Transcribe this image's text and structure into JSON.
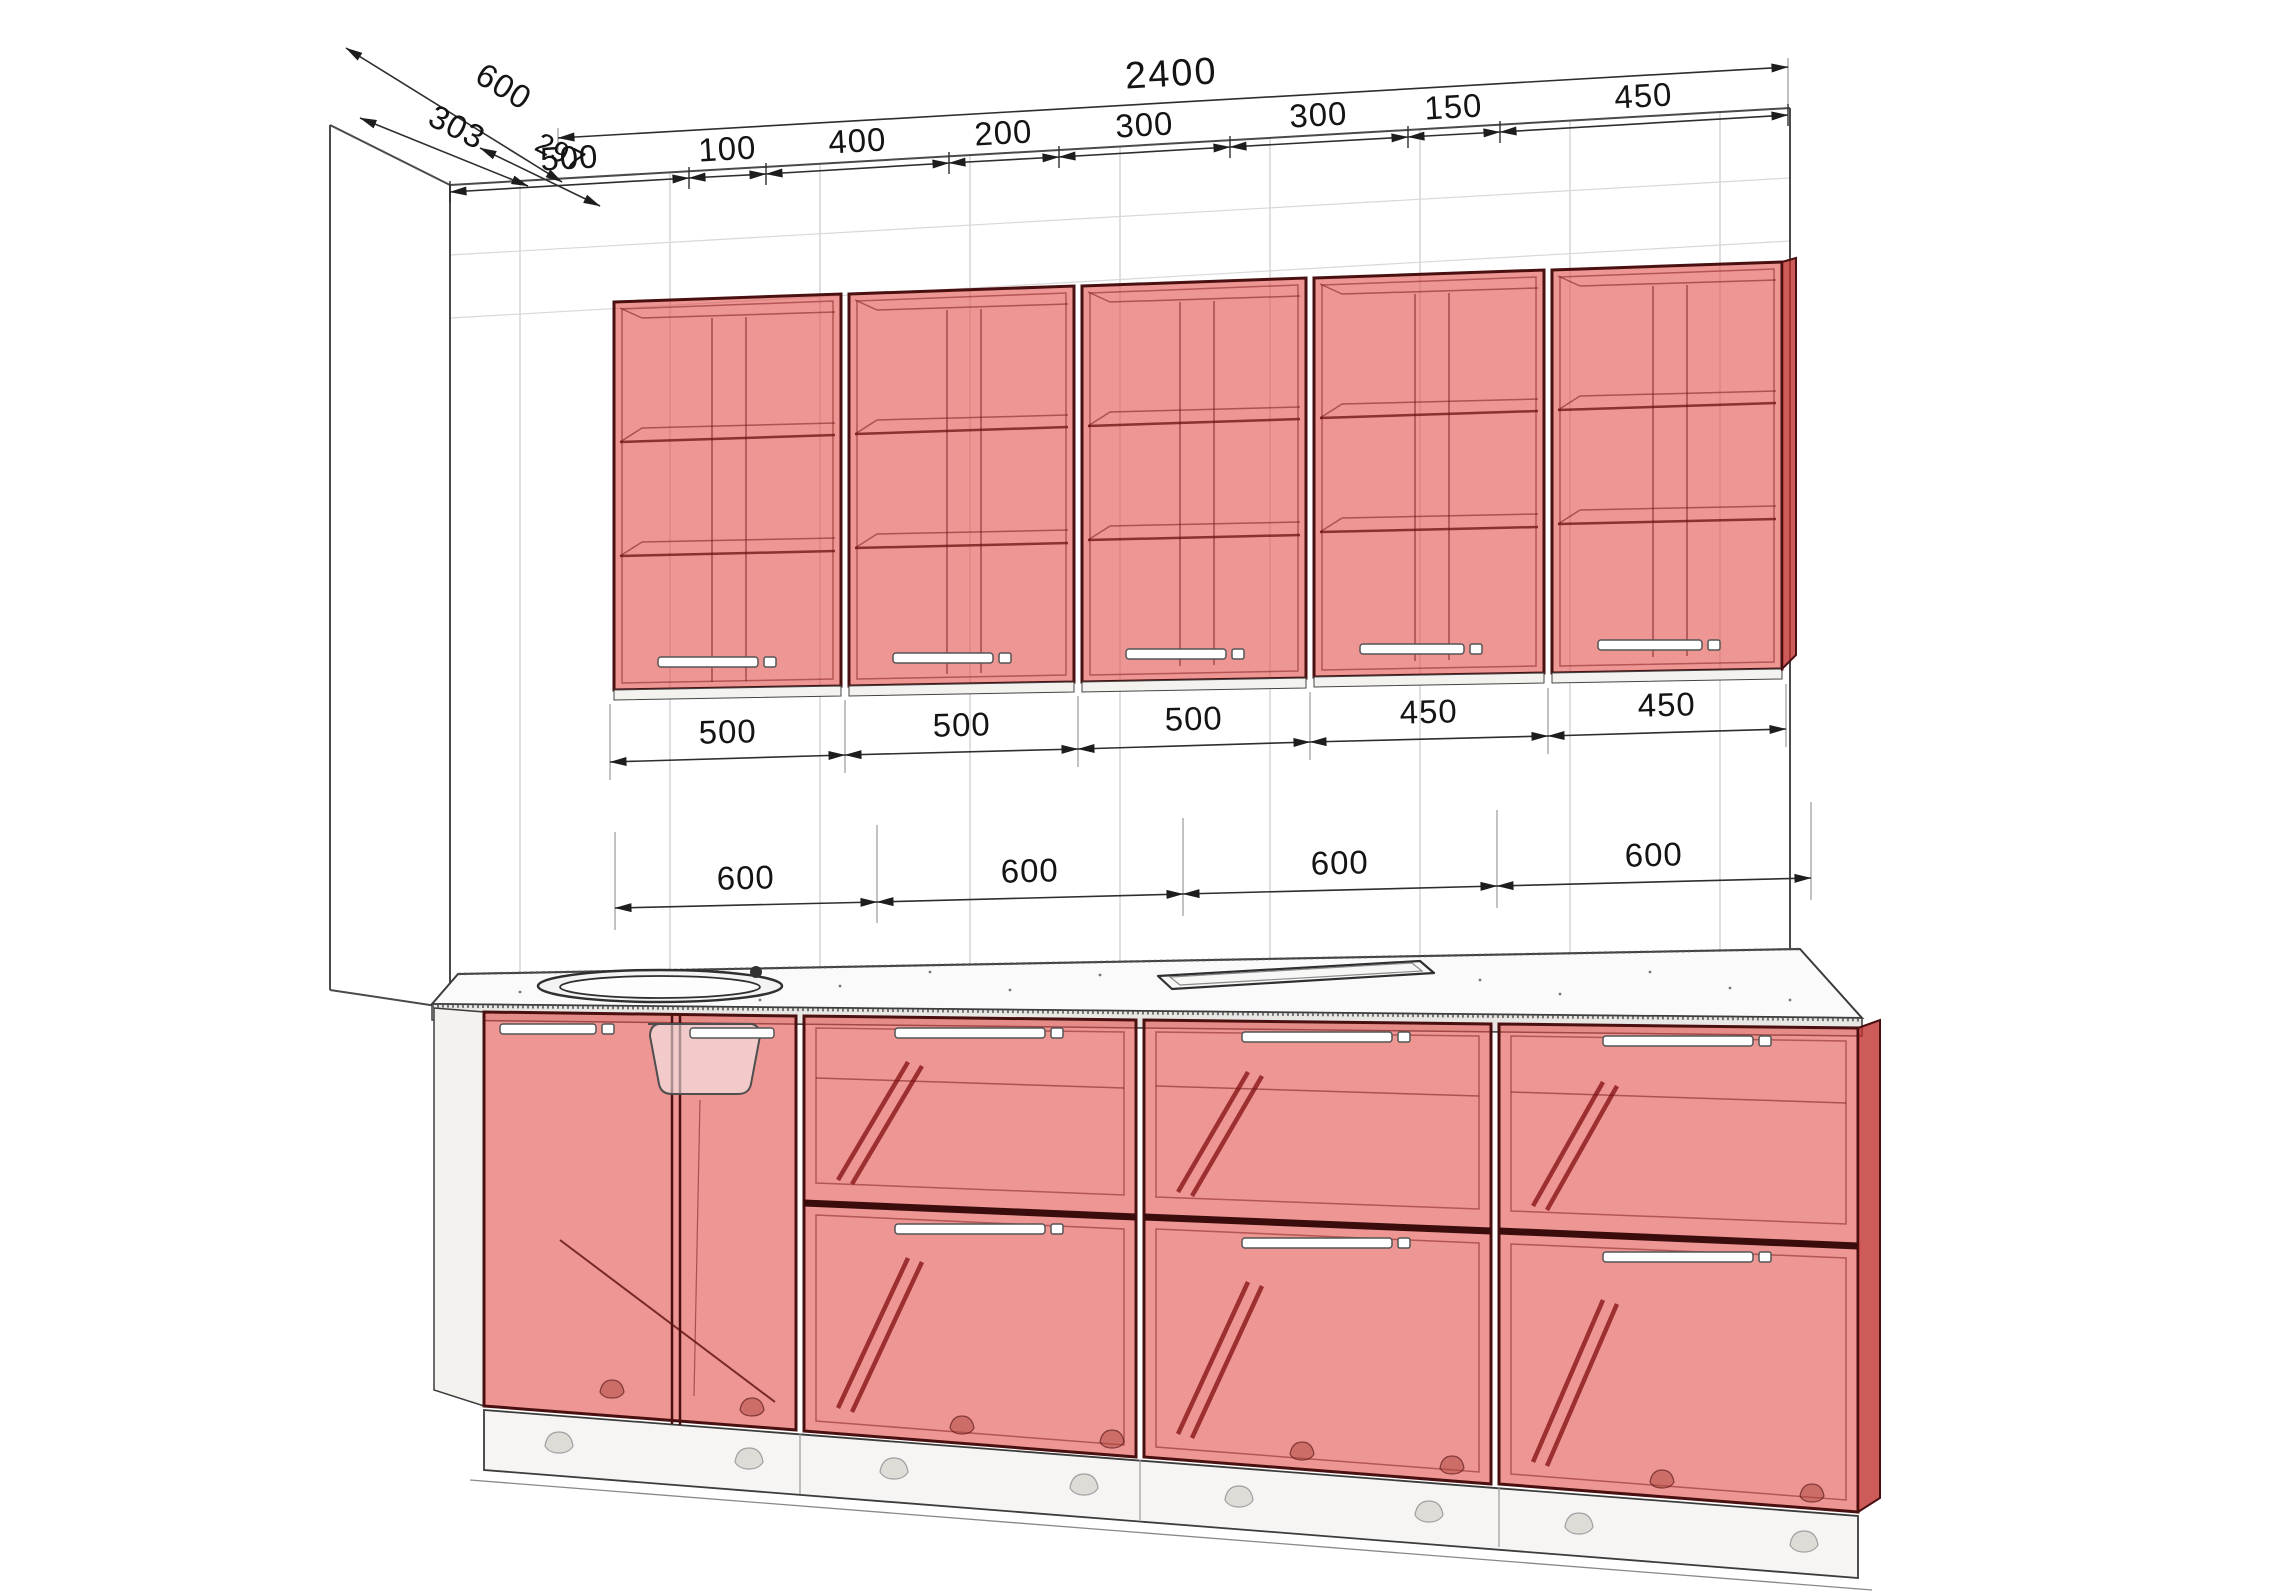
{
  "diagram": {
    "overall_width": "2400",
    "top_segments": [
      "500",
      "100",
      "400",
      "200",
      "300",
      "300",
      "150",
      "450"
    ],
    "depth_dims": [
      "600",
      "303",
      "297"
    ],
    "upper_cabinet_widths": [
      "500",
      "500",
      "500",
      "450",
      "450"
    ],
    "base_cabinet_widths": [
      "600",
      "600",
      "600",
      "600"
    ],
    "colors": {
      "cabinet_fill": "#e0504c",
      "cabinet_edge": "#4a1010",
      "dimension_line": "#2e2e2e",
      "wall_grid": "#cccccc",
      "countertop": "#fbfafa"
    }
  }
}
